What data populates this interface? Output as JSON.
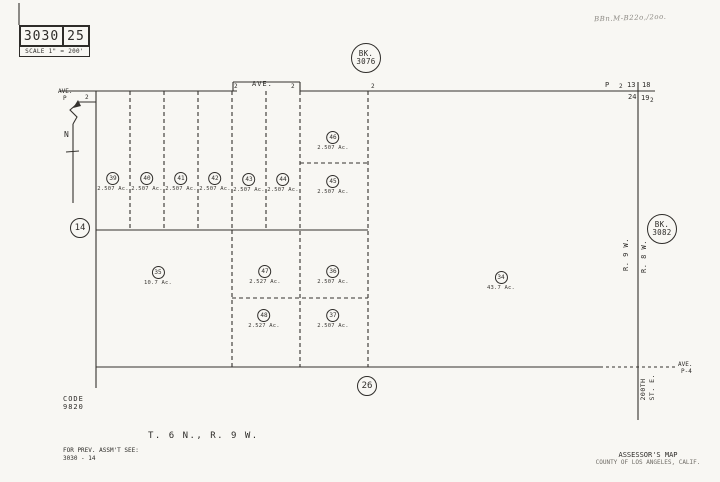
{
  "colors": {
    "paper": "#f8f7f3",
    "ink": "#2e2c29"
  },
  "title_block": {
    "book": "3030",
    "page": "25",
    "scale": "SCALE 1\" = 200'"
  },
  "handwriting": "BBn.M-B22o,/2oo.",
  "bk_top": {
    "l1": "BK.",
    "l2": "3076"
  },
  "bk_right": {
    "l1": "BK.",
    "l2": "3082"
  },
  "section_left": "14",
  "section_bottom": "26",
  "north_label": "N",
  "ave_p": {
    "l1": "AVE.",
    "l2": "P"
  },
  "ave_center": "AVE.",
  "ave_p4": {
    "l1": "AVE.",
    "l2": "P-4"
  },
  "street_200th": {
    "l1": "200TH",
    "l2": "ST. E."
  },
  "range_west": "R. 9 W.",
  "range_east": "R. 8 W.",
  "corner": {
    "p": "P",
    "t1": "2",
    "nw": "13",
    "ne": "18",
    "sw": "24",
    "se": "19",
    "t2": "2"
  },
  "township": "T. 6 N., R. 9 W.",
  "code": {
    "l1": "CODE",
    "l2": "9820"
  },
  "prev_assmt": {
    "l1": "FOR PREV. ASSM'T SEE:",
    "l2": "3030 - 14"
  },
  "assessor": {
    "l1": "ASSESSOR'S MAP",
    "l2": "COUNTY OF LOS ANGELES, CALIF."
  },
  "ticks": [
    {
      "t": "2",
      "x": 85,
      "y": 94
    },
    {
      "t": "2",
      "x": 234,
      "y": 83
    },
    {
      "t": "2",
      "x": 291,
      "y": 83
    },
    {
      "t": "2",
      "x": 371,
      "y": 83
    }
  ],
  "parcels": [
    {
      "n": "39",
      "ac": "2.507 Ac.",
      "x": 113,
      "y": 182
    },
    {
      "n": "40",
      "ac": "2.507 Ac.",
      "x": 147,
      "y": 182
    },
    {
      "n": "41",
      "ac": "2.507 Ac.",
      "x": 181,
      "y": 182
    },
    {
      "n": "42",
      "ac": "2.507 Ac.",
      "x": 215,
      "y": 182
    },
    {
      "n": "43",
      "ac": "2.507 Ac.",
      "x": 249,
      "y": 183
    },
    {
      "n": "44",
      "ac": "2.507 Ac.",
      "x": 283,
      "y": 183
    },
    {
      "n": "46",
      "ac": "2.507 Ac.",
      "x": 333,
      "y": 141
    },
    {
      "n": "45",
      "ac": "2.507 Ac.",
      "x": 333,
      "y": 185
    },
    {
      "n": "35",
      "ac": "10.7 Ac.",
      "x": 158,
      "y": 276
    },
    {
      "n": "47",
      "ac": "2.527 Ac.",
      "x": 265,
      "y": 275
    },
    {
      "n": "36",
      "ac": "2.507 Ac.",
      "x": 333,
      "y": 275
    },
    {
      "n": "48",
      "ac": "2.527 Ac.",
      "x": 264,
      "y": 319
    },
    {
      "n": "37",
      "ac": "2.507 Ac.",
      "x": 333,
      "y": 319
    },
    {
      "n": "34",
      "ac": "43.7 Ac.",
      "x": 501,
      "y": 281
    }
  ]
}
